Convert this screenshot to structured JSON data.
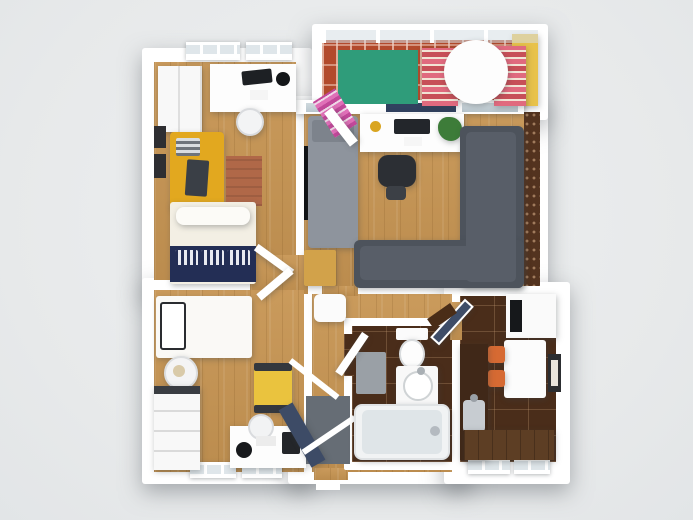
{
  "scene": {
    "description": "3D rendered top-down floor plan of a two-bedroom apartment with balcony, hallway, bathroom and kitchen",
    "background": "#e9ebec",
    "rooms": [
      "bedroom-1",
      "bedroom-2",
      "living-room",
      "balcony",
      "hallway",
      "bathroom",
      "kitchen"
    ],
    "palette": {
      "wall": "#ffffff",
      "wood": "#c79553",
      "counter": "#5d3e24",
      "tile": "#4a2d1a",
      "brick": "#b24a2c",
      "accent": "#53331f",
      "navy": "#232e55",
      "stripeA": "#e06a7e",
      "stripeB": "#c74f58",
      "rugTerra": "#b06848",
      "rugGreen": "#2f9c7a",
      "yellowWall": "#e8c24b",
      "yellowSofa": "#e2a81f",
      "yellowChair": "#eac33e",
      "sofaDark": "#4d535c",
      "sofaLight": "#8e949d",
      "orangeChair": "#d66a33",
      "doorNavy": "#3d4b66",
      "matGray": "#666d75",
      "chestWood": "#d2a24a"
    },
    "items": [
      {
        "n": "base-bedroom-1",
        "cls": "base",
        "x": 142,
        "y": 48,
        "w": 170,
        "h": 246
      },
      {
        "n": "base-bedroom-2",
        "cls": "base",
        "x": 142,
        "y": 278,
        "w": 170,
        "h": 206
      },
      {
        "n": "base-living-room",
        "cls": "base",
        "x": 288,
        "y": 96,
        "w": 260,
        "h": 202
      },
      {
        "n": "base-balcony",
        "cls": "base",
        "x": 312,
        "y": 24,
        "w": 236,
        "h": 96
      },
      {
        "n": "base-hall-bathroom",
        "cls": "base",
        "x": 288,
        "y": 282,
        "w": 184,
        "h": 202
      },
      {
        "n": "base-kitchen",
        "cls": "base",
        "x": 444,
        "y": 282,
        "w": 126,
        "h": 202
      },
      {
        "n": "floor-bedroom-1",
        "cls": "wood",
        "x": 154,
        "y": 62,
        "w": 142,
        "h": 218
      },
      {
        "n": "floor-lobby",
        "cls": "wood",
        "x": 250,
        "y": 255,
        "w": 58,
        "h": 39
      },
      {
        "n": "floor-bedroom-2",
        "cls": "wood",
        "x": 154,
        "y": 290,
        "w": 150,
        "h": 182
      },
      {
        "n": "floor-living-room",
        "cls": "wood",
        "x": 304,
        "y": 112,
        "w": 220,
        "h": 174
      },
      {
        "n": "floor-hallway",
        "cls": "wood",
        "x": 312,
        "y": 294,
        "w": 140,
        "h": 178
      },
      {
        "n": "floor-opening-living-hall",
        "cls": "wood",
        "x": 322,
        "y": 286,
        "w": 36,
        "h": 10
      },
      {
        "n": "floor-opening-entry",
        "cls": "wood",
        "x": 314,
        "y": 468,
        "w": 34,
        "h": 12
      },
      {
        "n": "accent-brick-wall",
        "cls": "accentw",
        "x": 524,
        "y": 112,
        "w": 16,
        "h": 174
      },
      {
        "n": "floor-balcony",
        "cls": "brick",
        "x": 322,
        "y": 40,
        "w": 190,
        "h": 66
      },
      {
        "n": "balcony-yellow-wall",
        "c": "#e8c24b",
        "x": 512,
        "y": 34,
        "w": 26,
        "h": 72,
        "sh": 1
      },
      {
        "n": "balcony-glass-railing",
        "cls": "railing",
        "x": 322,
        "y": 28,
        "w": 216,
        "h": 13
      },
      {
        "n": "bathroom-wall-box",
        "c": "#ffffff",
        "x": 344,
        "y": 318,
        "w": 118,
        "h": 152,
        "r": 2
      },
      {
        "n": "floor-bathroom",
        "cls": "tile",
        "x": 352,
        "y": 326,
        "w": 100,
        "h": 136
      },
      {
        "n": "floor-kitchen",
        "cls": "tile",
        "x": 460,
        "y": 296,
        "w": 96,
        "h": 166
      },
      {
        "n": "floor-opening-hall-kitchen",
        "cls": "wood",
        "x": 450,
        "y": 302,
        "w": 12,
        "h": 38
      },
      {
        "n": "floor-opening-hall-bathroom",
        "cls": "tile",
        "x": 344,
        "y": 334,
        "w": 10,
        "h": 42
      },
      {
        "n": "window-bedroom1-a",
        "cls": "window",
        "x": 186,
        "y": 42,
        "w": 54,
        "h": 18
      },
      {
        "n": "window-bedroom1-b",
        "cls": "window",
        "x": 246,
        "y": 42,
        "w": 46,
        "h": 18
      },
      {
        "n": "window-bedroom2-a",
        "cls": "window",
        "x": 190,
        "y": 462,
        "w": 46,
        "h": 16
      },
      {
        "n": "window-bedroom2-b",
        "cls": "window",
        "x": 242,
        "y": 462,
        "w": 40,
        "h": 16
      },
      {
        "n": "window-kitchen-a",
        "cls": "window",
        "x": 468,
        "y": 458,
        "w": 42,
        "h": 16
      },
      {
        "n": "window-kitchen-b",
        "cls": "window",
        "x": 514,
        "y": 458,
        "w": 36,
        "h": 16
      },
      {
        "n": "living-window-band",
        "c": "#ffffff",
        "x": 296,
        "y": 100,
        "w": 228,
        "h": 14,
        "sh": 1
      },
      {
        "n": "living-window-glass-a",
        "cls": "glass",
        "x": 306,
        "y": 103,
        "w": 20,
        "h": 9
      },
      {
        "n": "living-window-glass-navy",
        "c": "#31415f",
        "x": 386,
        "y": 103,
        "w": 70,
        "h": 9
      },
      {
        "n": "living-window-glass-b",
        "cls": "glass",
        "x": 462,
        "y": 103,
        "w": 56,
        "h": 9
      },
      {
        "n": "entry-door-threshold",
        "c": "#ffffff",
        "x": 316,
        "y": 482,
        "w": 24,
        "h": 8
      },
      {
        "n": "wardrobe-bedroom1",
        "c": "#f8f8f8",
        "cls": "seamv",
        "x": 158,
        "y": 66,
        "w": 44,
        "h": 66,
        "sh": 1
      },
      {
        "n": "desk-bedroom1",
        "c": "#fdfdfd",
        "x": 210,
        "y": 64,
        "w": 86,
        "h": 48,
        "sh": 1
      },
      {
        "n": "laptop-bedroom1",
        "c": "#1d2024",
        "x": 242,
        "y": 70,
        "w": 30,
        "h": 14,
        "rot": -6,
        "r": 2
      },
      {
        "n": "desk-lamp-bedroom1",
        "c": "#141619",
        "x": 276,
        "y": 72,
        "w": 14,
        "h": 14,
        "r": "50%"
      },
      {
        "n": "paper-bedroom1",
        "c": "#f5f5f5",
        "x": 250,
        "y": 90,
        "w": 18,
        "h": 10
      },
      {
        "n": "chair-bedroom1",
        "c": "#f3f4f5",
        "x": 236,
        "y": 108,
        "w": 28,
        "h": 28,
        "r": "50%",
        "bd": "2px solid #d9dbde",
        "sh": 1
      },
      {
        "n": "picture-frame-a",
        "c": "#2e2e32",
        "x": 154,
        "y": 126,
        "w": 12,
        "h": 22
      },
      {
        "n": "picture-frame-b",
        "c": "#2e2e32",
        "x": 154,
        "y": 154,
        "w": 12,
        "h": 24
      },
      {
        "n": "sofa-yellow-bedroom1",
        "c": "#e2a81f",
        "x": 170,
        "y": 132,
        "w": 54,
        "h": 78,
        "r": 4,
        "sh": 1
      },
      {
        "n": "pillow-striped",
        "cls": "stripesgray",
        "x": 176,
        "y": 138,
        "w": 24,
        "h": 18,
        "r": 2
      },
      {
        "n": "throw-dark",
        "c": "#3a3f46",
        "x": 186,
        "y": 160,
        "w": 22,
        "h": 36,
        "r": 2,
        "rot": 4
      },
      {
        "n": "rug-terracotta",
        "cls": "rugterra",
        "x": 226,
        "y": 156,
        "w": 36,
        "h": 50
      },
      {
        "n": "bed-double-mattress",
        "c": "#f3efe4",
        "x": 170,
        "y": 202,
        "w": 86,
        "h": 82,
        "r": 3,
        "sh": 1
      },
      {
        "n": "bed-double-pillow",
        "c": "#fcfbf7",
        "x": 176,
        "y": 207,
        "w": 74,
        "h": 18,
        "r": 8,
        "sh": 1
      },
      {
        "n": "bed-double-duvet-navy",
        "c": "#232e55",
        "x": 170,
        "y": 246,
        "w": 86,
        "h": 36
      },
      {
        "n": "pillow-pattern-a",
        "cls": "navypat",
        "x": 175,
        "y": 250,
        "w": 23,
        "h": 15,
        "r": 2
      },
      {
        "n": "pillow-pattern-b",
        "cls": "navypat",
        "x": 201,
        "y": 250,
        "w": 23,
        "h": 15,
        "r": 2
      },
      {
        "n": "pillow-pattern-c",
        "cls": "navypat",
        "x": 227,
        "y": 250,
        "w": 23,
        "h": 15,
        "r": 2
      },
      {
        "n": "tv-wall-mounted",
        "c": "#101214",
        "x": 304,
        "y": 146,
        "w": 6,
        "h": 74
      },
      {
        "n": "sofa-bed-gray",
        "c": "#8e949d",
        "x": 308,
        "y": 116,
        "w": 50,
        "h": 132,
        "r": 4,
        "sh": 1
      },
      {
        "n": "sofa-bed-pillow",
        "c": "#7d838c",
        "x": 312,
        "y": 120,
        "w": 42,
        "h": 22,
        "r": 3
      },
      {
        "n": "chest-wood",
        "c": "#d2a24a",
        "x": 304,
        "y": 250,
        "w": 32,
        "h": 36,
        "r": 2,
        "sh": 1
      },
      {
        "n": "desk-living",
        "c": "#fdfdfd",
        "x": 360,
        "y": 114,
        "w": 104,
        "h": 38,
        "sh": 1
      },
      {
        "n": "plant-potted",
        "c": "#3d7c39",
        "x": 438,
        "y": 117,
        "w": 24,
        "h": 24,
        "r": "45% 55% 50% 60%",
        "sh": 1
      },
      {
        "n": "bowl-yellow",
        "c": "#d9a521",
        "x": 370,
        "y": 121,
        "w": 11,
        "h": 11,
        "r": "50%"
      },
      {
        "n": "laptop-living",
        "c": "#23262b",
        "x": 394,
        "y": 119,
        "w": 36,
        "h": 15,
        "r": 2
      },
      {
        "n": "paper-living",
        "c": "#f6f6f6",
        "x": 404,
        "y": 137,
        "w": 18,
        "h": 9
      },
      {
        "n": "office-chair-seat",
        "c": "#2c2f34",
        "x": 378,
        "y": 155,
        "w": 38,
        "h": 32,
        "r": 10,
        "sh": 1
      },
      {
        "n": "office-chair-base",
        "c": "#3c4046",
        "x": 386,
        "y": 186,
        "w": 20,
        "h": 14,
        "r": 4
      },
      {
        "n": "sofa-corner-vertical",
        "c": "#4d535c",
        "x": 460,
        "y": 126,
        "w": 64,
        "h": 162,
        "r": 6,
        "sh": 1
      },
      {
        "n": "sofa-corner-horizontal",
        "c": "#4d535c",
        "x": 354,
        "y": 240,
        "w": 170,
        "h": 48,
        "r": 6,
        "sh": 1
      },
      {
        "n": "sofa-corner-cushion-v",
        "c": "#585e68",
        "x": 466,
        "y": 132,
        "w": 50,
        "h": 150,
        "r": 5
      },
      {
        "n": "sofa-corner-cushion-h",
        "c": "#585e68",
        "x": 360,
        "y": 246,
        "w": 150,
        "h": 34,
        "r": 5
      },
      {
        "n": "rug-green-balcony",
        "c": "#2f9c7a",
        "x": 338,
        "y": 50,
        "w": 80,
        "h": 54
      },
      {
        "n": "lounge-chair-a",
        "cls": "stripespink",
        "x": 422,
        "y": 48,
        "w": 36,
        "h": 58,
        "sh": 1
      },
      {
        "n": "lounge-chair-b",
        "cls": "stripespink",
        "x": 494,
        "y": 46,
        "w": 32,
        "h": 60,
        "sh": 1
      },
      {
        "n": "table-round-balcony",
        "c": "#fdfdfd",
        "x": 444,
        "y": 40,
        "w": 64,
        "h": 64,
        "r": "50%",
        "sh": 1
      },
      {
        "n": "lounge-folded-magenta",
        "cls": "stripesmag",
        "x": 322,
        "y": 92,
        "w": 26,
        "h": 42,
        "rot": -32
      },
      {
        "n": "bed-single",
        "c": "#faf9f6",
        "x": 156,
        "y": 296,
        "w": 96,
        "h": 62,
        "r": 3,
        "sh": 1
      },
      {
        "n": "bed-single-pillow",
        "c": "#ffffff",
        "x": 160,
        "y": 302,
        "w": 26,
        "h": 48,
        "r": 3,
        "bd": "2px solid #2a2c30"
      },
      {
        "n": "side-table-round",
        "c": "#f4f4f5",
        "x": 164,
        "y": 356,
        "w": 34,
        "h": 34,
        "r": "50%",
        "bd": "2px solid #dcdee0",
        "sh": 1
      },
      {
        "n": "deco-bowl",
        "c": "#d9caa9",
        "x": 173,
        "y": 365,
        "w": 12,
        "h": 12,
        "r": "50%"
      },
      {
        "n": "dresser-bedroom2",
        "c": "#f8f8f8",
        "cls": "drawersH",
        "x": 154,
        "y": 386,
        "w": 46,
        "h": 84,
        "sh": 1
      },
      {
        "n": "dresser-top-strip",
        "c": "#3a3d42",
        "x": 154,
        "y": 386,
        "w": 46,
        "h": 8
      },
      {
        "n": "armchair-yellow",
        "c": "#eac33e",
        "x": 254,
        "y": 366,
        "w": 38,
        "h": 46,
        "r": 3,
        "sh": 1
      },
      {
        "n": "armchair-armrest-a",
        "c": "#34383e",
        "x": 254,
        "y": 363,
        "w": 38,
        "h": 8,
        "r": 2
      },
      {
        "n": "armchair-armrest-b",
        "c": "#34383e",
        "x": 254,
        "y": 405,
        "w": 38,
        "h": 8,
        "r": 2
      },
      {
        "n": "desk-bedroom2",
        "c": "#fdfdfd",
        "x": 230,
        "y": 426,
        "w": 76,
        "h": 42,
        "sh": 1
      },
      {
        "n": "chair-bedroom2",
        "c": "#f2f3f4",
        "x": 248,
        "y": 414,
        "w": 26,
        "h": 26,
        "r": "50%",
        "bd": "2px solid #d9dbde"
      },
      {
        "n": "speaker-bedroom2",
        "c": "#17191c",
        "x": 236,
        "y": 442,
        "w": 16,
        "h": 16,
        "r": "50%"
      },
      {
        "n": "monitor-bedroom2",
        "c": "#24262a",
        "x": 282,
        "y": 432,
        "w": 18,
        "h": 22,
        "r": 2
      },
      {
        "n": "keyboard-bedroom2",
        "c": "#ececec",
        "x": 256,
        "y": 436,
        "w": 20,
        "h": 10
      },
      {
        "n": "pouf-hallway",
        "c": "#fbfbfb",
        "x": 314,
        "y": 294,
        "w": 32,
        "h": 28,
        "r": 6,
        "sh": 1
      },
      {
        "n": "entry-door-mat",
        "c": "#666d75",
        "x": 306,
        "y": 396,
        "w": 44,
        "h": 68
      },
      {
        "n": "front-door-navy",
        "c": "#3d4b66",
        "x": 294,
        "y": 402,
        "w": 16,
        "h": 66,
        "rot": -30,
        "sh": 1
      },
      {
        "n": "door-swing-a",
        "c": "#ffffff",
        "x": 284,
        "y": 376,
        "w": 60,
        "h": 6,
        "rot": 38
      },
      {
        "n": "door-swing-b",
        "c": "#ffffff",
        "x": 298,
        "y": 432,
        "w": 62,
        "h": 6,
        "rot": -34
      },
      {
        "n": "door-leaf-bedroom1",
        "c": "#ffffff",
        "x": 252,
        "y": 256,
        "w": 44,
        "h": 8,
        "rot": 36,
        "sh": 1
      },
      {
        "n": "door-leaf-bedroom2",
        "c": "#ffffff",
        "x": 254,
        "y": 280,
        "w": 42,
        "h": 8,
        "rot": -40,
        "sh": 1
      },
      {
        "n": "toilet-tank",
        "c": "#fbfbfb",
        "x": 396,
        "y": 328,
        "w": 32,
        "h": 12,
        "r": 2
      },
      {
        "n": "toilet-bowl",
        "c": "#fdfdfd",
        "x": 399,
        "y": 339,
        "w": 26,
        "h": 30,
        "r": "50%",
        "bd": "2px solid #d9dcde",
        "sh": 1
      },
      {
        "n": "bath-mat",
        "c": "#9aa0a6",
        "x": 356,
        "y": 352,
        "w": 30,
        "h": 42,
        "r": 2
      },
      {
        "n": "vanity-bathroom",
        "c": "#f8f8f8",
        "x": 396,
        "y": 366,
        "w": 42,
        "h": 46,
        "r": 3,
        "sh": 1
      },
      {
        "n": "sink-round",
        "c": "#ffffff",
        "x": 403,
        "y": 371,
        "w": 30,
        "h": 30,
        "r": "50%",
        "bd": "2px solid #cfd3d5"
      },
      {
        "n": "faucet-bathroom",
        "c": "#a9afb4",
        "x": 417,
        "y": 367,
        "w": 8,
        "h": 8,
        "r": "50%"
      },
      {
        "n": "bathtub",
        "c": "#f1f3f4",
        "x": 354,
        "y": 404,
        "w": 96,
        "h": 56,
        "r": 8,
        "bd": "2px solid #dfe2e4",
        "sh": 1
      },
      {
        "n": "bathtub-inner",
        "c": "#dfe5e8",
        "x": 362,
        "y": 410,
        "w": 80,
        "h": 44,
        "r": 6
      },
      {
        "n": "tub-faucet",
        "c": "#b4bac0",
        "x": 430,
        "y": 426,
        "w": 10,
        "h": 10,
        "r": "50%"
      },
      {
        "n": "door-leaf-bathroom",
        "c": "#ffffff",
        "x": 348,
        "y": 330,
        "w": 8,
        "h": 48,
        "rot": 34,
        "sh": 1
      },
      {
        "n": "fridge-kitchen",
        "c": "#fafafa",
        "x": 506,
        "y": 294,
        "w": 50,
        "h": 44,
        "sh": 1
      },
      {
        "n": "fridge-front-panel",
        "c": "#16181b",
        "x": 510,
        "y": 300,
        "w": 12,
        "h": 32
      },
      {
        "n": "dining-table",
        "c": "#fcfcfc",
        "x": 504,
        "y": 340,
        "w": 42,
        "h": 58,
        "r": 3,
        "sh": 1
      },
      {
        "n": "chair-orange-a",
        "c": "#d66a33",
        "x": 488,
        "y": 346,
        "w": 17,
        "h": 17,
        "r": 3,
        "sh": 1
      },
      {
        "n": "chair-orange-b",
        "c": "#d66a33",
        "x": 488,
        "y": 370,
        "w": 17,
        "h": 17,
        "r": 3,
        "sh": 1
      },
      {
        "n": "picture-kitchen-frame",
        "c": "#2c2e31",
        "x": 548,
        "y": 354,
        "w": 13,
        "h": 38
      },
      {
        "n": "picture-kitchen-art",
        "c": "#e9e5dd",
        "x": 551,
        "y": 360,
        "w": 7,
        "h": 26
      },
      {
        "n": "counter-dark-left",
        "c": "#402818",
        "x": 460,
        "y": 344,
        "w": 28,
        "h": 116,
        "sh": 1
      },
      {
        "n": "sink-kitchen",
        "c": "#c7ccd1",
        "x": 463,
        "y": 400,
        "w": 22,
        "h": 32,
        "r": 4
      },
      {
        "n": "faucet-kitchen",
        "c": "#9aa0a6",
        "x": 470,
        "y": 394,
        "w": 8,
        "h": 8,
        "r": "50%"
      },
      {
        "n": "counter-bottom",
        "cls": "wooddark",
        "x": 464,
        "y": 430,
        "w": 90,
        "h": 30,
        "sh": 1
      },
      {
        "n": "door-kitchen-glass",
        "c": "#3e4d68",
        "x": 446,
        "y": 296,
        "w": 12,
        "h": 52,
        "rot": 42,
        "bd": "2px solid #ffffff",
        "sh": 1
      },
      {
        "n": "shelf-board",
        "c": "#4a2d17",
        "x": 428,
        "y": 310,
        "w": 28,
        "h": 12,
        "rot": -35
      },
      {
        "n": "door-leaf-balcony",
        "c": "#ffffff",
        "x": 336,
        "y": 106,
        "w": 10,
        "h": 42,
        "rot": -38,
        "sh": 1
      }
    ]
  }
}
